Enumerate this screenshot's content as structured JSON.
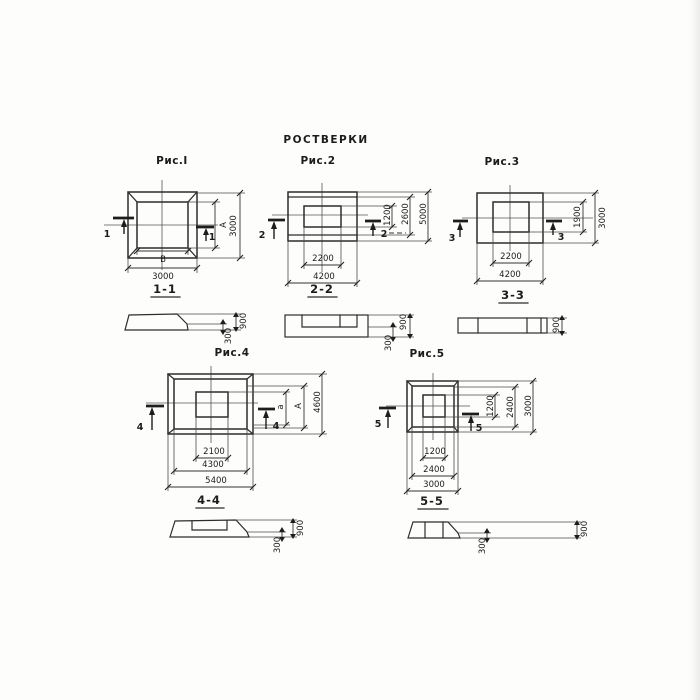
{
  "title": "РОСТВЕРКИ",
  "palette": {
    "paper": "#fdfdfc",
    "line": "#2d2d2d"
  },
  "fig1": {
    "caption": "Рис.I",
    "cut": "1",
    "plan": {
      "inner_w": "В",
      "outer_w": "3000",
      "inner_h": "А",
      "outer_h": "3000"
    },
    "section": {
      "label": "1-1",
      "total_h": "900",
      "ledge_h": "300"
    }
  },
  "fig2": {
    "caption": "Рис.2",
    "cut": "2",
    "plan": {
      "inner_w": "2200",
      "outer_w": "4200",
      "inner_h": "1200",
      "mid_h": "2600",
      "outer_h": "5000"
    },
    "section": {
      "label": "2-2",
      "total_h": "900",
      "ledge_h": "300"
    }
  },
  "fig3": {
    "caption": "Рис.3",
    "cut": "3",
    "plan": {
      "inner_w": "2200",
      "outer_w": "4200",
      "inner_h": "1900",
      "outer_h": "3000"
    },
    "section": {
      "label": "3-3",
      "total_h": "900"
    }
  },
  "fig4": {
    "caption": "Рис.4",
    "cut": "4",
    "plan": {
      "inner_w": "2100",
      "mid_w": "4300",
      "outer_w": "5400",
      "inner_h": "а",
      "mid_h": "А",
      "outer_h": "4600"
    },
    "section": {
      "label": "4-4",
      "total_h": "900",
      "ledge_h": "300"
    }
  },
  "fig5": {
    "caption": "Рис.5",
    "cut": "5",
    "plan": {
      "inner_w": "1200",
      "mid_w": "2400",
      "outer_w": "3000",
      "inner_h": "1200",
      "mid_h": "2400",
      "outer_h": "3000"
    },
    "section": {
      "label": "5-5",
      "total_h": "900",
      "ledge_h": "300"
    }
  }
}
